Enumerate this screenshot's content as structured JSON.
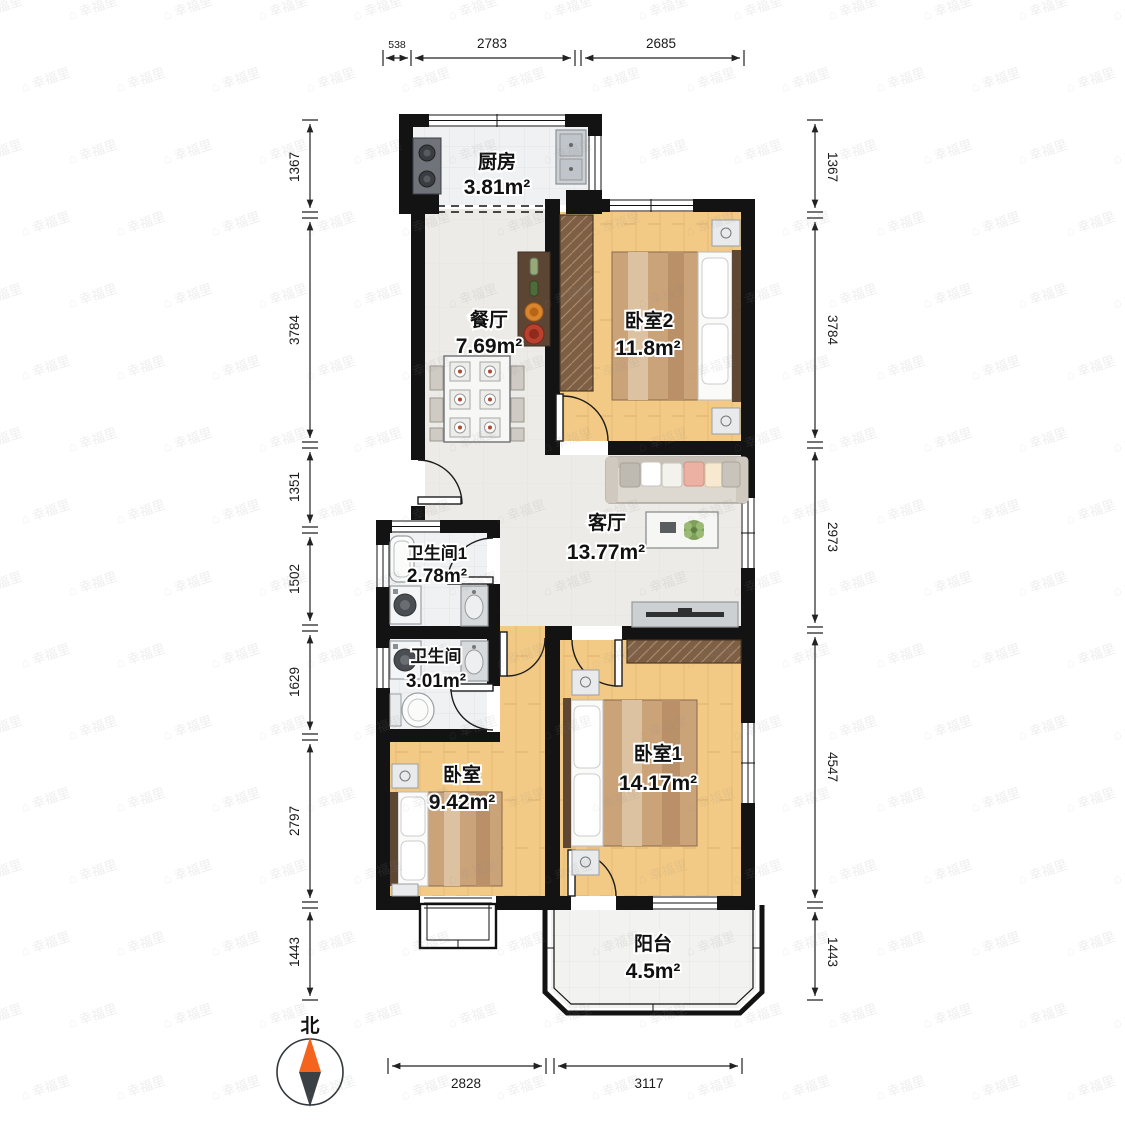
{
  "meta": {
    "title": "户型图"
  },
  "compass": {
    "label": "北"
  },
  "watermark": {
    "icon": "⌂",
    "text": "幸福里"
  },
  "rooms": {
    "kitchen": {
      "name": "厨房",
      "area": "3.81m²"
    },
    "dining": {
      "name": "餐厅",
      "area": "7.69m²"
    },
    "bedroom2": {
      "name": "卧室2",
      "area": "11.8m²"
    },
    "living": {
      "name": "客厅",
      "area": "13.77m²"
    },
    "bathroom1": {
      "name": "卫生间1",
      "area": "2.78m²"
    },
    "bathroom": {
      "name": "卫生间",
      "area": "3.01m²"
    },
    "bedroom_small": {
      "name": "卧室",
      "area": "9.42m²"
    },
    "bedroom1": {
      "name": "卧室1",
      "area": "14.17m²"
    },
    "balcony": {
      "name": "阳台",
      "area": "4.5m²"
    }
  },
  "dimensions": {
    "top": [
      "538",
      "2783",
      "2685"
    ],
    "left": [
      "1367",
      "3784",
      "1351",
      "1502",
      "1629",
      "2797",
      "1443"
    ],
    "right": [
      "1367",
      "3784",
      "2973",
      "4547",
      "1443"
    ],
    "bottom": [
      "2828",
      "3117"
    ]
  },
  "colors": {
    "wall": "#131313",
    "wood_floor": "#F3CA85",
    "tile_floor": "#EDEBE7",
    "wet_floor": "#EFF1F3",
    "furniture_brown": "#7D5F45",
    "compass_north": "#F4641E",
    "compass_south": "#3B4045"
  }
}
